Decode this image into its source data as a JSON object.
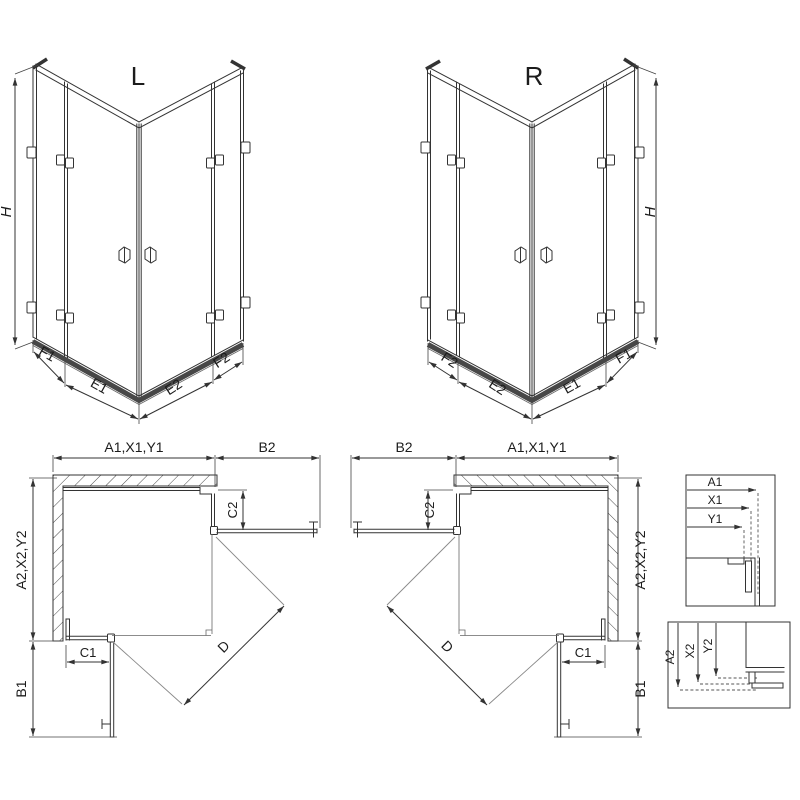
{
  "drawing": {
    "kind": "shower-enclosure-technical-diagram",
    "views": [
      "isometric-left",
      "isometric-right",
      "plan-left",
      "plan-right",
      "detail-horizontal",
      "detail-vertical"
    ]
  },
  "colors": {
    "background": "#ffffff",
    "line": "#333333",
    "tray": "#474747",
    "swing": "#888888"
  },
  "iso_left": {
    "title": "L",
    "height_dim": "H",
    "bottom_dims": [
      "F1",
      "E1",
      "E2",
      "F2"
    ]
  },
  "iso_right": {
    "title": "R",
    "height_dim": "H",
    "bottom_dims": [
      "F2",
      "E2",
      "E1",
      "F1"
    ]
  },
  "plan_left": {
    "top_dims": [
      "A1,X1,Y1",
      "B2"
    ],
    "side_dims": [
      "A2,X2,Y2",
      "B1"
    ],
    "return_dims": [
      "C2",
      "C1"
    ],
    "diagonal_dim": "D"
  },
  "plan_right": {
    "top_dims": [
      "B2",
      "A1,X1,Y1"
    ],
    "side_dims": [
      "A2,X2,Y2",
      "B1"
    ],
    "return_dims": [
      "C2",
      "C1"
    ],
    "diagonal_dim": "D"
  },
  "detail_top": {
    "dims": [
      "A1",
      "X1",
      "Y1"
    ]
  },
  "detail_bottom": {
    "dims": [
      "A2",
      "X2",
      "Y2"
    ]
  }
}
